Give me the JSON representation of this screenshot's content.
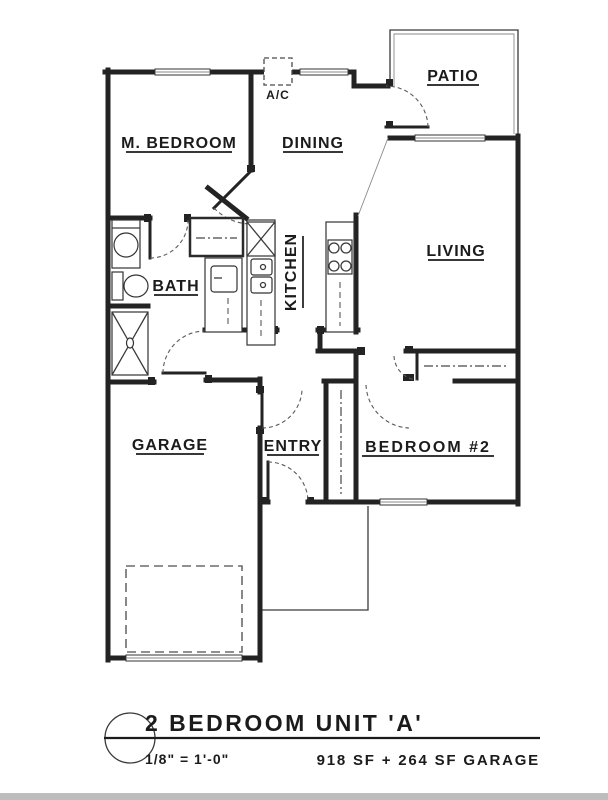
{
  "rooms": {
    "m_bedroom": "M. BEDROOM",
    "dining": "DINING",
    "patio": "PATIO",
    "living": "LIVING",
    "kitchen": "KITCHEN",
    "bath": "BATH",
    "garage": "GARAGE",
    "entry": "ENTRY",
    "bedroom2": "BEDROOM #2",
    "ac": "A/C"
  },
  "title_block": {
    "title": "2 BEDROOM UNIT 'A'",
    "scale": "1/8\" = 1'-0\"",
    "area": "918 SF + 264 SF GARAGE"
  }
}
